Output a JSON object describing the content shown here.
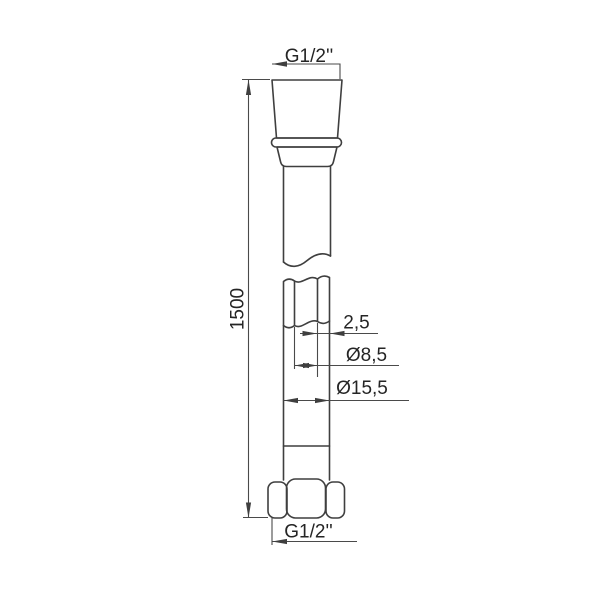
{
  "drawing": {
    "description": "technical line drawing of a shower hose with dimension callouts",
    "labels": {
      "top_thread": "G1/2''",
      "length": "1500",
      "wall_thickness": "2,5",
      "inner_diameter": "Ø8,5",
      "outer_diameter": "Ø15,5",
      "bottom_thread": "G1/2''"
    },
    "colors": {
      "line": "#3f3f3f",
      "dimension_line": "#4a4a4a",
      "text": "#252525",
      "background": "#ffffff"
    }
  }
}
